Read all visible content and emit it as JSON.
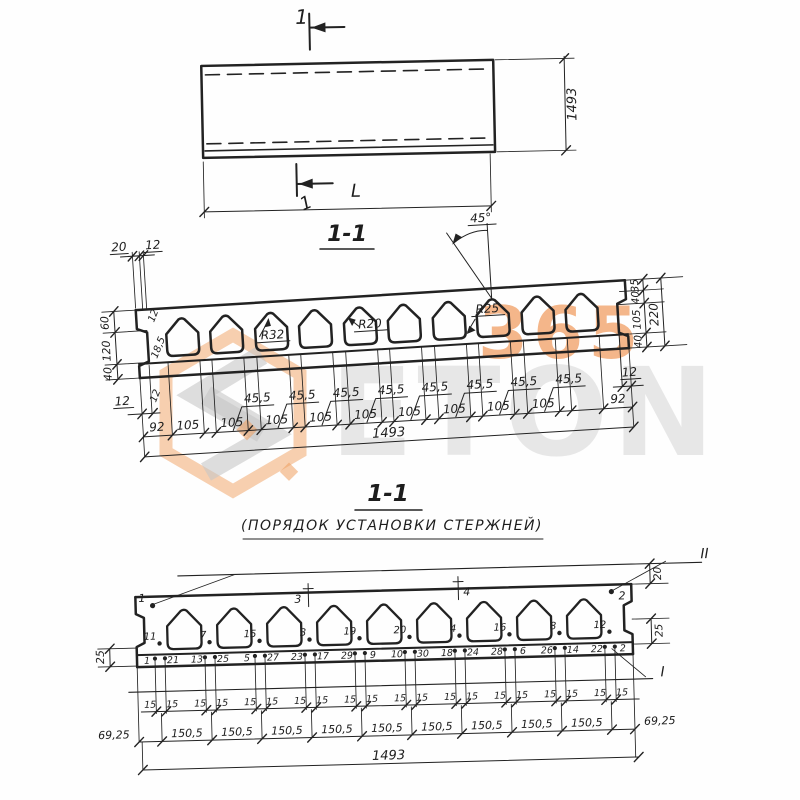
{
  "watermark": {
    "brand": "ETON",
    "number": "365",
    "orange": "#ef9f5f",
    "gray": "#c6c6c6"
  },
  "top_view": {
    "section_mark": "1",
    "dim_width": "1493",
    "dim_length": "L"
  },
  "section": {
    "title": "1-1",
    "top_dims": [
      "20",
      "12"
    ],
    "left_chain": [
      "60",
      "120",
      "40"
    ],
    "inner_dims": [
      "12",
      "18,5",
      "12"
    ],
    "left_web_dim": "12",
    "radii": [
      "R32",
      "R20",
      "R25"
    ],
    "angle": "45°",
    "right_chain": [
      "35",
      "40",
      "105",
      "40"
    ],
    "right_total": "220",
    "right_web_dim": "12",
    "bottom_chain": [
      "92",
      "105",
      "105",
      "105",
      "105",
      "105",
      "105",
      "105",
      "105",
      "105",
      "92"
    ],
    "web_dims": [
      "45,5",
      "45,5",
      "45,5",
      "45,5",
      "45,5",
      "45,5",
      "45,5",
      "45,5"
    ],
    "total": "1493"
  },
  "placement": {
    "title": "1-1",
    "subtitle": "(ПОРЯДОК  УСТАНОВКИ  СТЕРЖНЕЙ)",
    "corner_marks": [
      "1",
      "2"
    ],
    "web_top_marks": [
      "3",
      "4"
    ],
    "mid_bars": [
      "11",
      "7",
      "15",
      "3",
      "19",
      "20",
      "4",
      "16",
      "8",
      "12"
    ],
    "bottom_bars_left": [
      "1",
      "13",
      "5",
      "23",
      "29",
      "10",
      "18",
      "28",
      "26",
      "22"
    ],
    "bottom_bars_right": [
      "21",
      "25",
      "27",
      "17",
      "9",
      "30",
      "24",
      "6",
      "14",
      "2"
    ],
    "left_dim": "25",
    "right_dims": [
      "20",
      "25"
    ],
    "cut_lines": [
      "II",
      "I"
    ],
    "spacing_dim": "15",
    "row_chain": [
      "69,25",
      "150,5",
      "150,5",
      "150,5",
      "150,5",
      "150,5",
      "150,5",
      "150,5",
      "150,5",
      "150,5",
      "69,25"
    ],
    "total": "1493"
  }
}
